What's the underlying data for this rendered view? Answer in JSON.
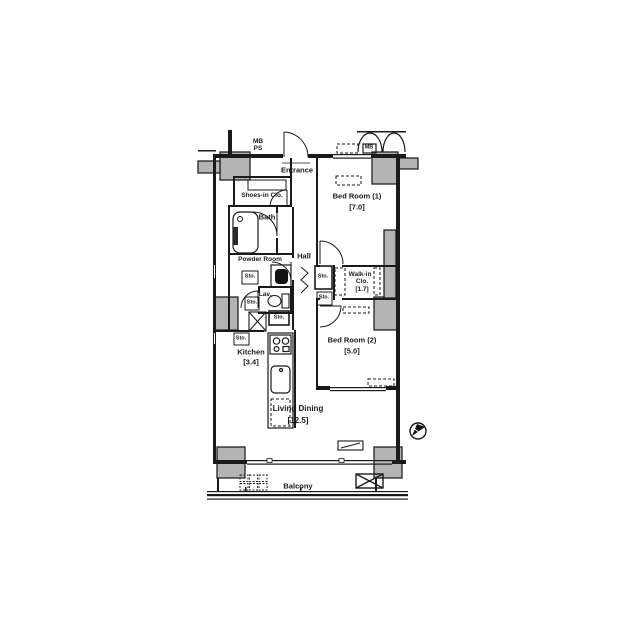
{
  "plan": {
    "title": "apartment-floor-plan",
    "rooms": {
      "entrance": {
        "label": "Entrance"
      },
      "shoes_closet": {
        "label": "Shoes-in Clo."
      },
      "bath": {
        "label": "Bath"
      },
      "powder_room": {
        "label": "Powder Room"
      },
      "lavatory": {
        "label": "Lav."
      },
      "hall": {
        "label": "Hall"
      },
      "bedroom1": {
        "label": "Bed Room (1)",
        "size": "[7.0]"
      },
      "bedroom2": {
        "label": "Bed Room (2)",
        "size": "[5.0]"
      },
      "walkin_closet": {
        "label_line1": "Walk-in",
        "label_line2": "Clo.",
        "size": "[1.7]"
      },
      "kitchen": {
        "label": "Kitchen",
        "size": "[3.4]"
      },
      "living_dining": {
        "label": "Living Dining",
        "size": "[12.5]"
      },
      "balcony": {
        "label": "Balcony"
      }
    },
    "annotations": {
      "meter_box": "MB",
      "pipe_space": "PS",
      "storage": "Sto."
    },
    "colors": {
      "wall": "#1a1a1a",
      "column_fill": "#b4b4b4",
      "background": "#ffffff"
    }
  }
}
